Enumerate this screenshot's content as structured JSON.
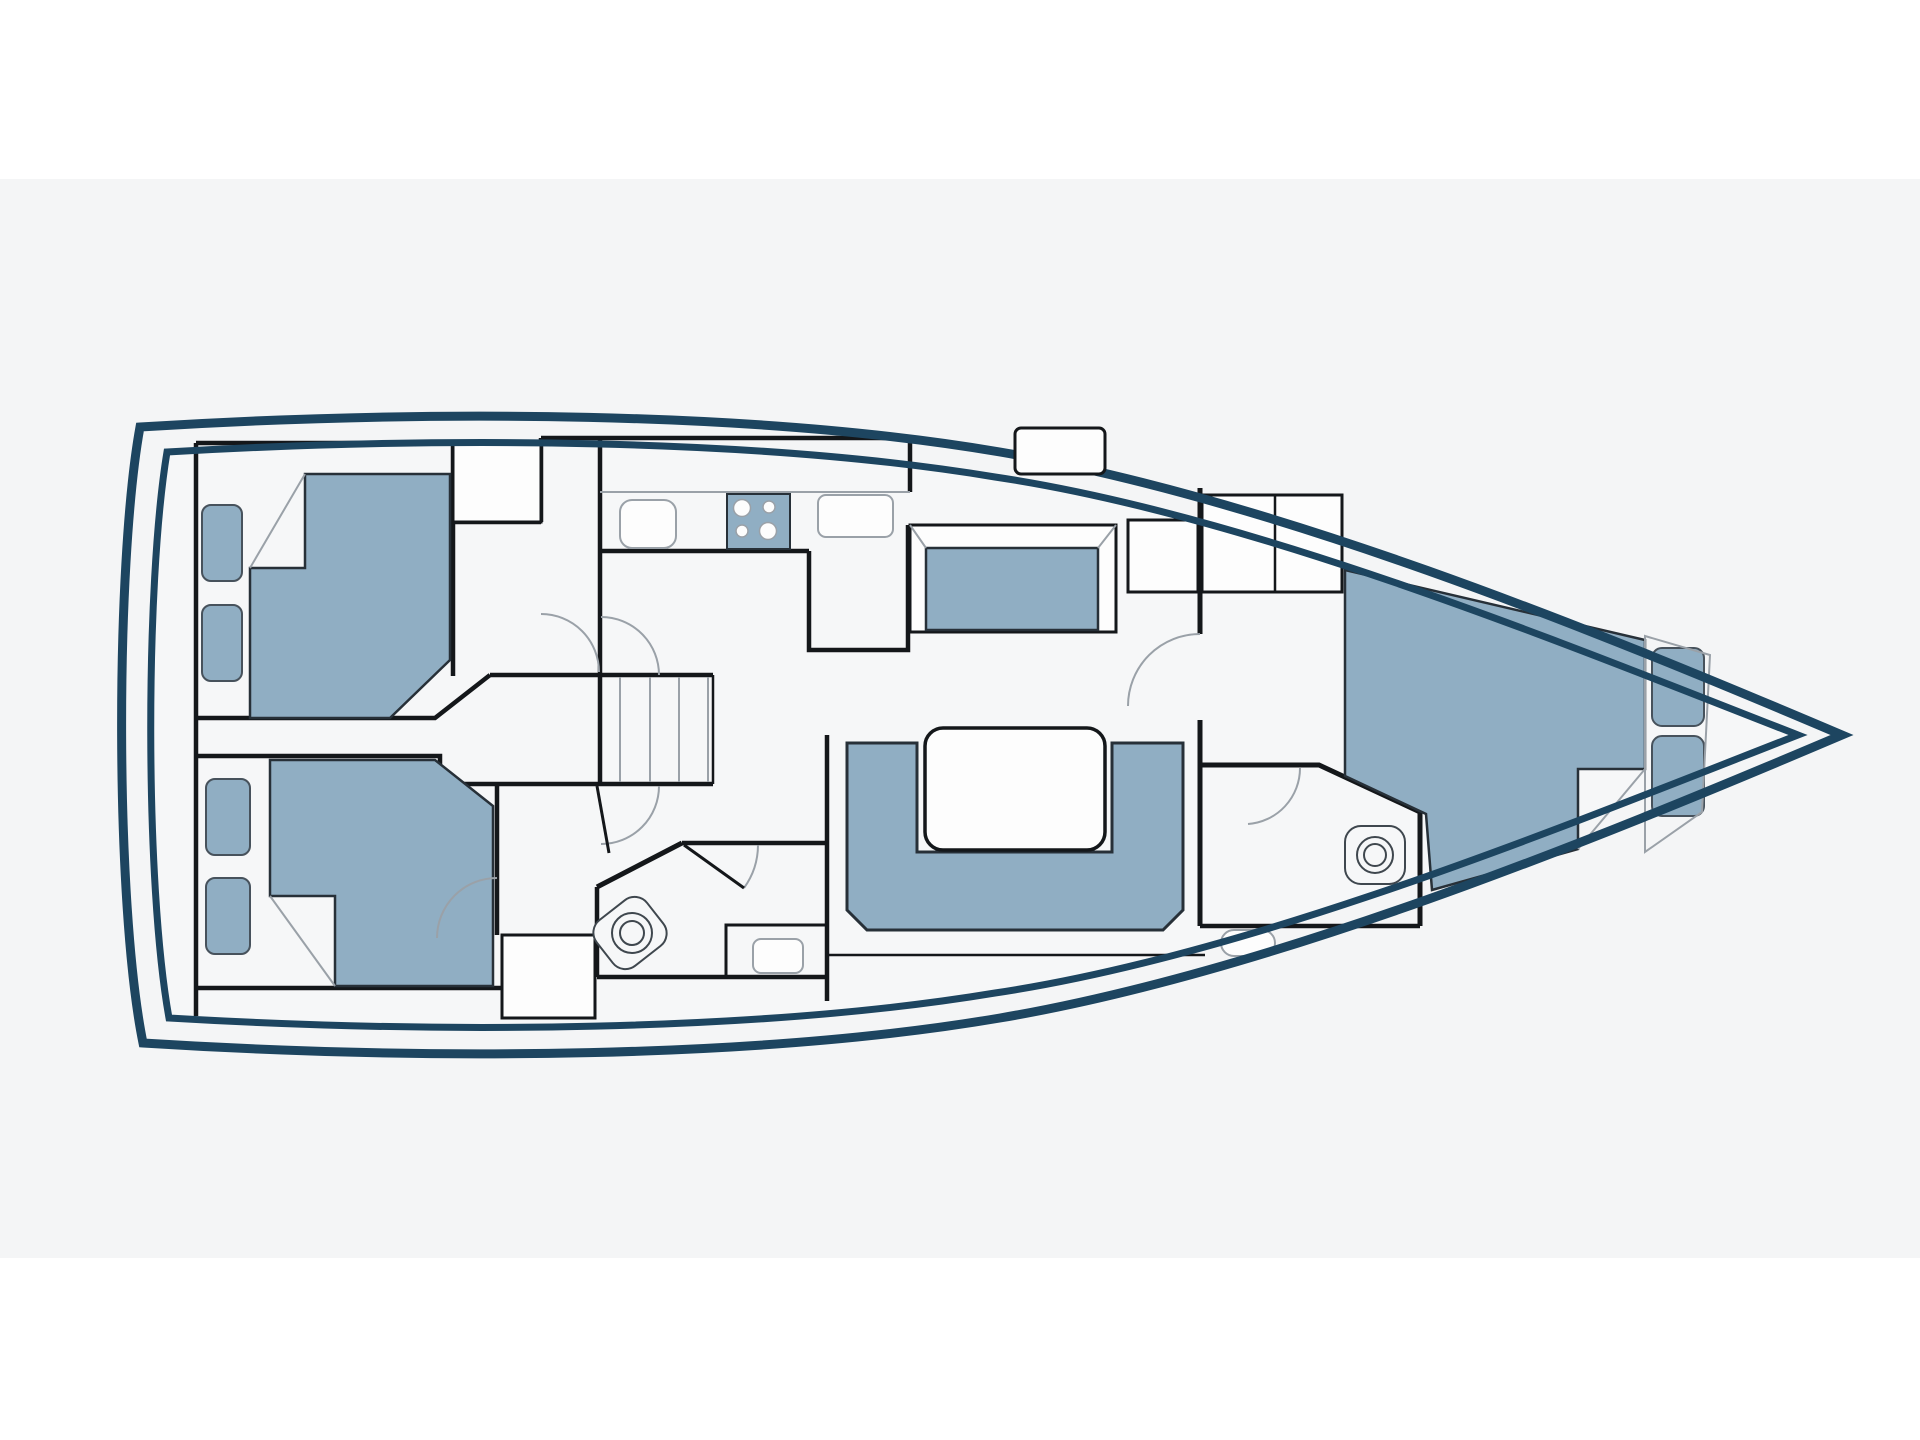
{
  "colors": {
    "page_background": "#ffffff",
    "band": "#f4f5f6",
    "interior": "#f6f7f8",
    "wall": "#14171a",
    "hull": "#1d4560",
    "furniture": "#90aec3",
    "furniture_stroke": "#273038",
    "pillow_stroke": "#47525c",
    "detail": "#9aa1a8",
    "fixture_stroke": "#3f474e",
    "white": "#fdfdfd"
  },
  "diagram": {
    "type": "yacht-deck-floor-plan",
    "orientation": "bow-right-stern-left",
    "rooms": [
      {
        "name": "aft-cabin-port",
        "furniture": [
          "double-bed",
          "pillow",
          "pillow",
          "wardrobe"
        ]
      },
      {
        "name": "aft-cabin-starboard",
        "furniture": [
          "double-bed",
          "pillow",
          "pillow",
          "wardrobe"
        ]
      },
      {
        "name": "corridor-companionway",
        "furniture": [
          "stairs-5-treads"
        ]
      },
      {
        "name": "galley",
        "furniture": [
          "sink",
          "stove-cooktop-4-burners",
          "drainer",
          "counter-peninsula"
        ]
      },
      {
        "name": "salon",
        "furniture": [
          "forward-facing-settee",
          "u-shaped-sofa",
          "salon-table"
        ]
      },
      {
        "name": "aft-head",
        "furniture": [
          "toilet",
          "washbasin"
        ]
      },
      {
        "name": "forward-head",
        "furniture": [
          "toilet",
          "washbasin"
        ]
      },
      {
        "name": "forward-cabin",
        "furniture": [
          "v-berth-double-bed",
          "pillow",
          "pillow",
          "lockers"
        ]
      }
    ],
    "deck_features": [
      "hull-double-outline",
      "transom",
      "bow",
      "side-decks",
      "deck-hatch"
    ]
  }
}
